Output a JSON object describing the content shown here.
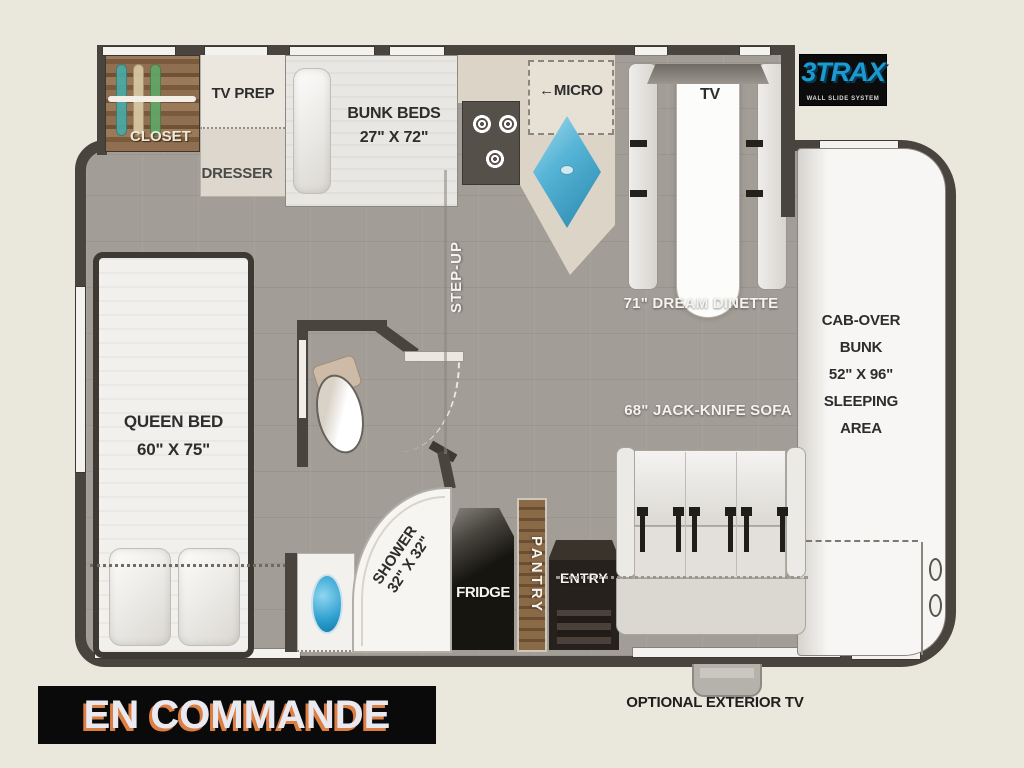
{
  "plan": {
    "closet": {
      "label": "CLOSET"
    },
    "tv_prep": {
      "label": "TV PREP"
    },
    "dresser": {
      "label": "DRESSER"
    },
    "bunk_beds": {
      "label": "BUNK BEDS",
      "size": "27\" X 72\""
    },
    "micro": {
      "arrow": "←",
      "label": "MICRO"
    },
    "tv": {
      "label": "TV"
    },
    "dinette": {
      "label": "71\" DREAM DINETTE"
    },
    "step_up": {
      "label": "STEP-UP"
    },
    "queen_bed": {
      "label": "QUEEN BED",
      "size": "60\" X 75\""
    },
    "cab_over": {
      "lines": [
        "CAB-OVER",
        "BUNK",
        "52\" X 96\"",
        "SLEEPING",
        "AREA"
      ]
    },
    "sofa": {
      "label": "68\" JACK-KNIFE SOFA"
    },
    "shower": {
      "label": "SHOWER",
      "size": "32\" X 32\""
    },
    "fridge": {
      "label": "FRIDGE"
    },
    "pantry": {
      "label": "PANTRY"
    },
    "entry": {
      "label": "ENTRY"
    },
    "exterior_tv": {
      "label": "OPTIONAL EXTERIOR TV"
    }
  },
  "logo": {
    "name": "3TRAX",
    "tagline": "WALL SLIDE SYSTEM"
  },
  "banner": {
    "label": "EN COMMANDE"
  },
  "colors": {
    "floor": "#a39d97",
    "wall": "#4a443e",
    "background": "#eae7dd",
    "sink_blue": "#3aa8dc",
    "wood": "#7a5a3c",
    "banner_bg": "#0a0a0a",
    "banner_shadow_orange": "#dd7e42",
    "logo_blue": "#1b9ad2"
  }
}
